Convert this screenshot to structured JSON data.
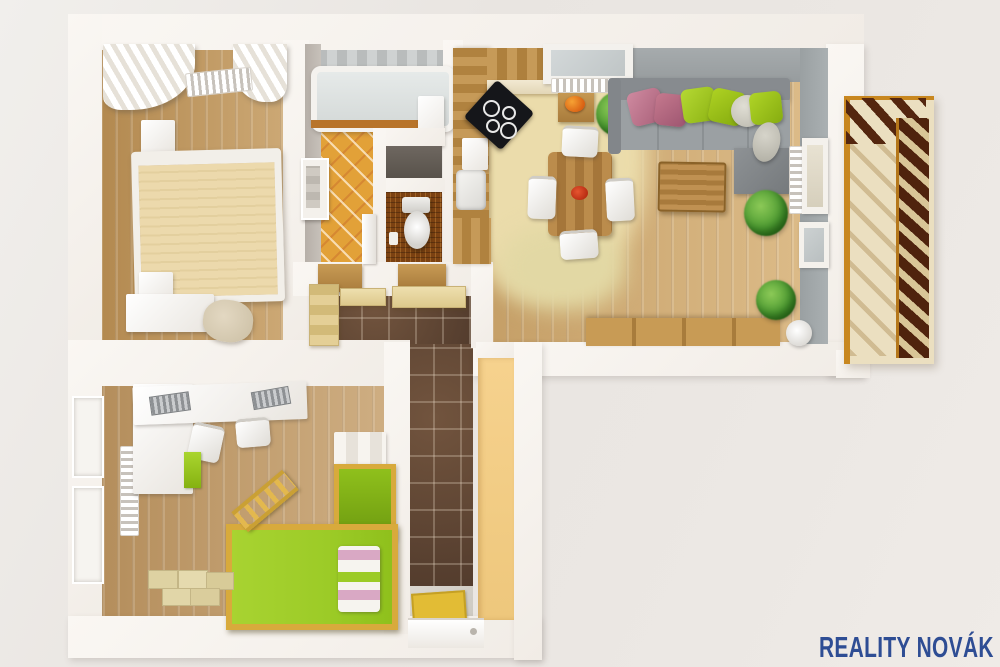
{
  "title": "3D apartment floor plan render (top-down)",
  "watermark": {
    "text": "REALITY NOVÁK",
    "color": "#2e4d94"
  },
  "palette": {
    "wall": "#faf7f3",
    "wood_floor": "#cda36a",
    "bath_tile": "#e2a138",
    "wc_floor": "#7c4212",
    "hall_tile": "#5e4433",
    "kitchen_floor_cream": "#ebdcab",
    "yellow_wall": "#f6d28e",
    "sofa_grey": "#878b8f",
    "sofa_seat_grey": "#9ba0a3",
    "pillow_pink": "#c5798e",
    "pillow_lime": "#a5ce1e",
    "pillow_white": "#d8d6cc",
    "bed_duvet": "#ecd9ac",
    "kids_bed_green": "#9ccb27",
    "kids_bed_frame": "#d8aa3c",
    "balcony_frame": "#c8871f",
    "balcony_rail_dark": "#4f230d",
    "doormat_yellow": "#e2bc35",
    "plant_green": "#4e9c32",
    "watermark_color": "#2e4d94"
  },
  "scene": {
    "rooms": [
      {
        "id": "bedroom",
        "label": "Bedroom",
        "furniture": [
          "window-curtains",
          "radiator",
          "double-bed",
          "nightstand",
          "dresser",
          "armchair"
        ]
      },
      {
        "id": "bathroom",
        "label": "Bathroom",
        "furniture": [
          "bathtub",
          "washbasin-cabinet",
          "wall-mirror"
        ]
      },
      {
        "id": "wc",
        "label": "Toilet room",
        "furniture": [
          "toilet",
          "paper-holder"
        ]
      },
      {
        "id": "kitchen-dining",
        "label": "Kitchen and dining",
        "furniture": [
          "kitchen-counter",
          "cooktop",
          "sink",
          "fruit-bowl",
          "dining-table",
          "four-chairs"
        ]
      },
      {
        "id": "living-room",
        "label": "Living room",
        "furniture": [
          "corner-sofa",
          "cushions",
          "ottoman",
          "coffee-table",
          "tv-sideboard",
          "plants",
          "radiator",
          "windows"
        ]
      },
      {
        "id": "hallway",
        "label": "Hallway",
        "furniture": [
          "built-in-wardrobes",
          "doormat",
          "entry-door"
        ]
      },
      {
        "id": "kids-room",
        "label": "Kids room",
        "furniture": [
          "corner-desk",
          "keyboards",
          "desk-chairs",
          "loft-bed",
          "ladder",
          "storage-boxes",
          "radiator",
          "windows"
        ]
      },
      {
        "id": "balcony",
        "label": "Balcony",
        "furniture": [
          "wooden-railing"
        ]
      }
    ]
  }
}
